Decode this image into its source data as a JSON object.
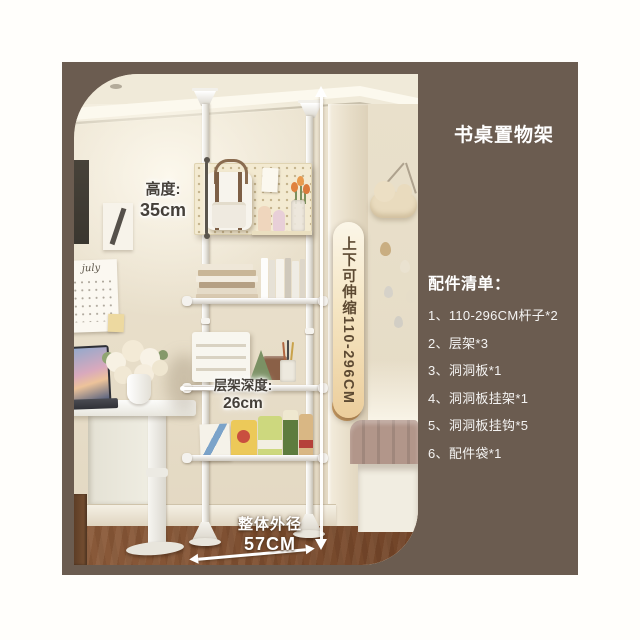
{
  "colors": {
    "page-bg": "#fffefb",
    "panel-bg": "#6b5c50",
    "pill-top": "#fbf6e8",
    "pill-bottom": "#ecce9c",
    "pill-text": "#5d4a33",
    "annotation-dark": "#45403a"
  },
  "header": {
    "title": "书桌置物架"
  },
  "accessories": {
    "heading": "配件清单：",
    "items": [
      "1、110-296CM杆子*2",
      "2、层架*3",
      "3、洞洞板*1",
      "4、洞洞板挂架*1",
      "5、洞洞板挂钩*5",
      "6、配件袋*1"
    ]
  },
  "annotations": {
    "height": {
      "label": "高度:",
      "value": "35cm"
    },
    "extend": {
      "label": "上下可伸缩110-296CM"
    },
    "depth": {
      "label": "层架深度:",
      "value": "26cm"
    },
    "overall": {
      "label": "整体外径",
      "value": "57CM"
    }
  },
  "photo": {
    "calendar_text": "july"
  }
}
